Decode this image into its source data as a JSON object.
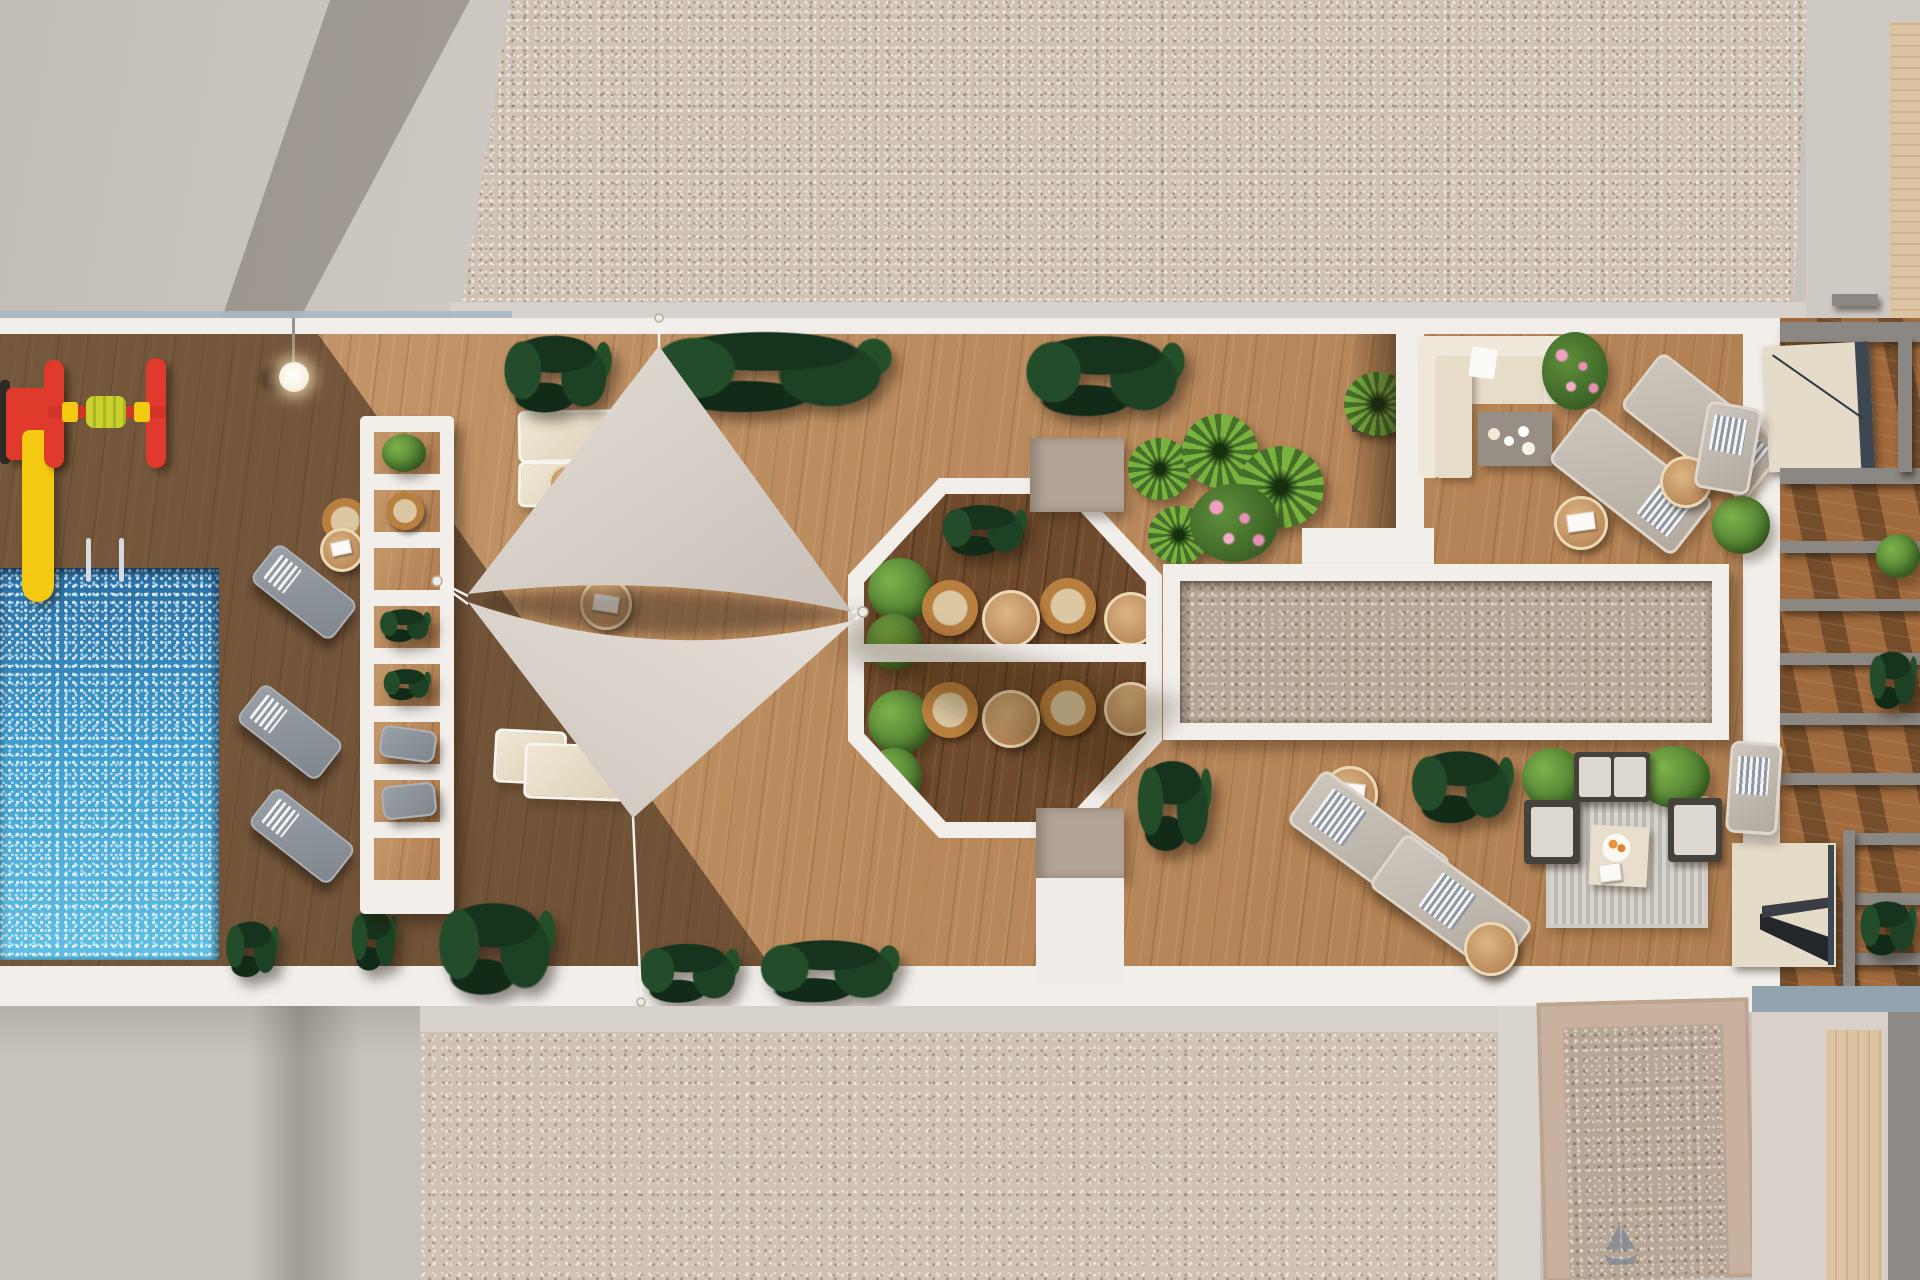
{
  "scene": {
    "title": "Aerial 3D render of a rooftop terrace with swimming pool, shade sails, octagonal dining patio and lounge decks",
    "view": "top-down aerial",
    "lighting": "low sun casting long diagonal shadows from the left"
  },
  "colors": {
    "concrete": "#c9c3bd",
    "concrete_shadow": "#a49d97",
    "frame_white": "#f2efeb",
    "gravel": "#cfc2b4",
    "gravel_brown": "#b7a695",
    "wood_light": "#b98758",
    "wood_dark": "#6f4a2c",
    "pool_blue": "#3f9ccd",
    "sail": "#ddd5cd",
    "plant_dark": "#1d4124",
    "plant_bright": "#6fa843",
    "wicker": "#b97f3f",
    "play_red": "#e03a2c",
    "play_yellow": "#f4c912",
    "lounger_gray": "#949aa2",
    "cushion_cream": "#e8decb",
    "taupe": "#b2a496",
    "beam_gray": "#8b8783",
    "stair_cream": "#e5dbc9",
    "rug": "#c9c6c0",
    "ladder_chrome": "#d5dbdf"
  },
  "areas": {
    "pool_zone": {
      "features": [
        "rectangular pool with sparkling water",
        "chrome pool ladder",
        "children playground with red-yellow slide and spinner",
        "post lamp",
        "3 gray sun loungers",
        "wicker side table",
        "white slatted pergola with planted gaps"
      ],
      "lounger_count": 3
    },
    "shade_sail_deck": {
      "features": [
        "two triangular shade sails anchored with cables",
        "4 cream loungers",
        "round wicker tables",
        "dark tropical planters along top and bottom edges"
      ],
      "sail_count": 2
    },
    "octagon_dining": {
      "features": [
        "white octagonal frame",
        "dark wood floor",
        "4 wicker armchairs",
        "2 round oak tables",
        "green bushes",
        "central white divider",
        "taupe utility squares above and below"
      ],
      "chair_count": 4
    },
    "lounge_corner": {
      "features": [
        "cream L-shaped sofa",
        "gray coffee table with plates",
        "pink flowering bush",
        "2 gray loungers",
        "round oak side tables",
        "green bush"
      ]
    },
    "sunbathing_corner": {
      "features": [
        "2 beige loungers with striped towels",
        "round oak tables",
        "dark tropical plant",
        "conversation set: striped rug, 2 dark armchairs, sofa, cream coffee table with orange fruit plate",
        "corner bushes"
      ]
    },
    "side_pergola": {
      "features": [
        "gray pergola beams over wood deck",
        "two cream stair landings",
        "green plants"
      ]
    },
    "surroundings": {
      "features": [
        "smooth concrete aprons",
        "pebble gravel bands top and bottom",
        "tan-framed gravel block with sketched sailboat",
        "central white-framed gravel skylight"
      ]
    }
  }
}
